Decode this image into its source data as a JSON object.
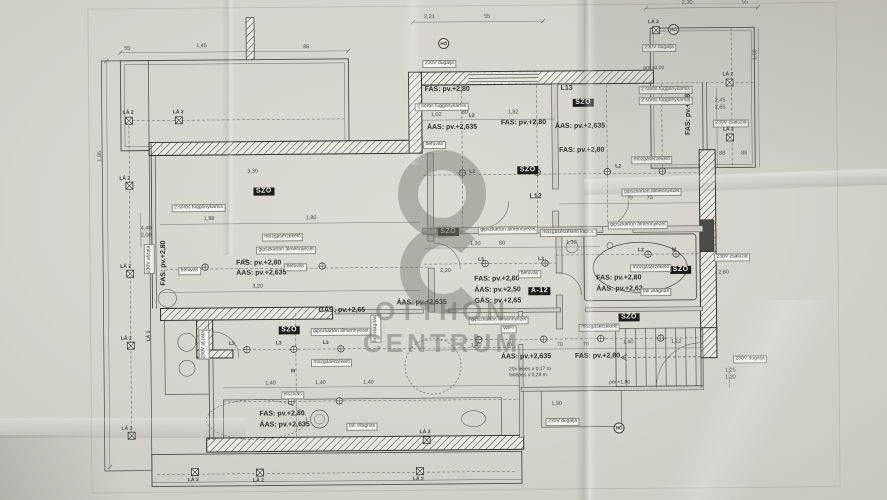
{
  "watermark": {
    "line1": "OTTHON",
    "line2": "CENTRUM"
  },
  "tags": {
    "szo": "SZÖ",
    "a12": "A-12"
  },
  "levels": {
    "fas": "FAS: pv.+2,80",
    "aas635": "ÁAS: pv.+2,635",
    "aas50": "ÁAS: pv.+2,50",
    "aas62": "ÁAS: pv.+2,62",
    "gas": "GÁS: pv.+2,65",
    "pm0": "pm ±0,00",
    "pm1": "pm +1,00"
  },
  "notes": {
    "ceiling": "gipszkarton álmennyezet",
    "curtain": "2 soros függönykarnis",
    "motion": "mozgásérzékelő",
    "motion_switch": "mozgásérzékelő kapcs.",
    "inflow": "befúvás",
    "extract": "elszívás",
    "wall_light": "fali világítás",
    "shutter": "230V zsaluzia",
    "socket": "230V dugalja",
    "outlet_strip": "230V aljzata",
    "wifi": "WIFI",
    "stair1": "20x lépés x 0,17 m",
    "stair2": "fellépés x 0,28 m"
  },
  "rooms": {
    "l12": "L12",
    "l13": "L13"
  },
  "markers": {
    "la1": "LÁ 1",
    "la2": "LÁ 2",
    "l2": "L2",
    "l3": "L3",
    "m": "M",
    "ho": "HŐ"
  },
  "dims": {
    "d55": "55",
    "d88": "88",
    "d221": "2,21",
    "d230": "2,30",
    "d145": "1,45",
    "d245": "2,45",
    "d265": "2,65",
    "d150": "1,50",
    "d330": "3,30",
    "d188": "1,88",
    "d180": "1,80",
    "d90": "90",
    "d320": "3,20",
    "d220": "2,20",
    "d130": "1,30",
    "d80": "80",
    "d102": "1,02",
    "d182": "1,82",
    "d70": "70",
    "d280": "2,80",
    "d140": "1,40",
    "d112": "1,12",
    "d125": "1,25",
    "d120": "1,20",
    "d185": "1,85",
    "d440": "4,40",
    "d200": "2,00",
    "d190": "1,90"
  }
}
